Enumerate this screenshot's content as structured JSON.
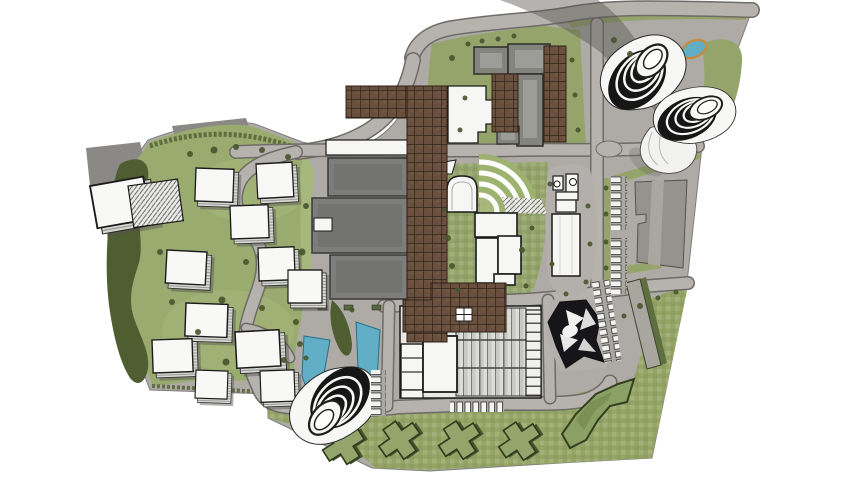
{
  "meta": {
    "description": "Top-down architectural masterplan rendering: campus with three spiral landmark towers, white cubic villas on lawns, three industrial slab halls, a long brown pergola canopy spine, gable-roof heritage building, amphitheater, glass-roof market hall, black faceted pavilion, green-roof cross houses, ponds, roads and parking rows on a white background.",
    "visible_text": []
  },
  "palette": {
    "site": "#aeaba6",
    "pad": "#b3b0ab",
    "road": "#b6b3ae",
    "roadEdge": "#6e6c68",
    "grass": "#94a46a",
    "grassW": "#9aab6f",
    "grassSE": "#96a566",
    "grassLight": "#a7b87c",
    "scrub": "#4f5e31",
    "canopyBrown": "#6a4f3e",
    "canopyLine": "#30241a",
    "slabGray": "#7d7d7b",
    "roofGray": "#84847f",
    "white": "#f6f6f4",
    "ink": "#1b1b1b",
    "water": "#62aec6",
    "pondRing": "#c98a3a",
    "glass": "#dcdcd9",
    "greenRoof": "#93a56b",
    "towerDark": "#161616"
  },
  "features": [
    {
      "name": "spiral-landmark-tower",
      "count": 3
    },
    {
      "name": "white-cube-villa",
      "count": 13
    },
    {
      "name": "hatched-roof-cube",
      "count": 1
    },
    {
      "name": "industrial-slab-hall",
      "count": 3
    },
    {
      "name": "gable-roof-building",
      "count": 1
    },
    {
      "name": "white-l-shaped-building",
      "count": 1
    },
    {
      "name": "pergola-canopy-spine",
      "count": 1
    },
    {
      "name": "pergola-canopy-wing",
      "count": 3
    },
    {
      "name": "amphitheater",
      "count": 1
    },
    {
      "name": "barrel-vault-pavilion",
      "count": 1
    },
    {
      "name": "white-midrise-block",
      "count": 4
    },
    {
      "name": "tower-topped-white-building",
      "count": 1
    },
    {
      "name": "glass-roof-market-hall",
      "count": 1
    },
    {
      "name": "black-faceted-pavilion",
      "count": 1
    },
    {
      "name": "angled-slab-building",
      "count": 1
    },
    {
      "name": "thin-green-edge-building",
      "count": 1
    },
    {
      "name": "chevron-green-roof-building",
      "count": 1
    },
    {
      "name": "cross-shaped-green-roof-house",
      "count": 4
    },
    {
      "name": "pond",
      "count": 3
    },
    {
      "name": "parking-row",
      "count": 5
    }
  ]
}
